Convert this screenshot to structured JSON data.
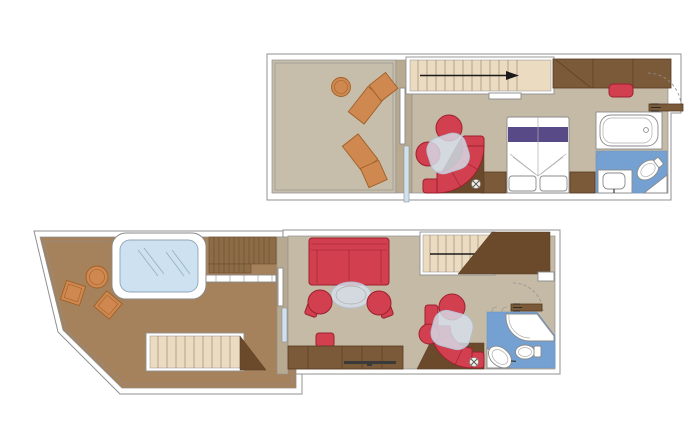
{
  "diagram_type": "cruise-duplex-suite-floor-plan",
  "palette": {
    "page-bg": "#ffffff",
    "wall": "#ffffff",
    "wall-stroke": "#909090",
    "wall-tan": "#b8aa91",
    "floor-tan": "#c5baa5",
    "floor-gray": "#c6bdab",
    "balcony-brown": "#a5815c",
    "slat-brown": "#8c6b47",
    "slat-line": "#6b4c2d",
    "stair-beige": "#eadbc1",
    "tread-line": "#9a8c74",
    "arrow": "#1a1a1a",
    "wood": "#7b5a3a",
    "wood-dark": "#553a20",
    "wood-deep": "#6b4a2c",
    "furn-red": "#d23f4e",
    "furn-red-dark": "#9c2030",
    "orange": "#ce8850",
    "orange-dark": "#a16026",
    "bed-purple": "#584a86",
    "bath-blue": "#74a0d2",
    "tub-blue": "#cde1f0",
    "tub-glass-line": "#93afc5",
    "glass": "#d6dfec",
    "glass-stroke": "#b2c0d2",
    "slider-glass": "#cfe0ee",
    "fixture-stroke": "#8a8a8a"
  },
  "floors": [
    {
      "id": "upper-level",
      "areas": [
        "private-terrace",
        "stair-landing",
        "bedroom",
        "bathtub-room",
        "wc-room"
      ],
      "furniture": [
        "sun-lounger",
        "sun-lounger",
        "round-side-table",
        "sliding-glass-door",
        "staircase",
        "curved-sofa",
        "armchair",
        "armchair",
        "glass-table",
        "double-bed",
        "nightstand",
        "nightstand",
        "wardrobe",
        "bench-stool",
        "entrance-door",
        "bathtub",
        "washbasin",
        "toilet"
      ],
      "stairs_arrow_direction": "right"
    },
    {
      "id": "lower-level",
      "areas": [
        "large-terrace",
        "terrace-deck",
        "terrace-stairs",
        "living-room",
        "stair-hall",
        "bathroom"
      ],
      "furniture": [
        "whirlpool-tub",
        "deck-chair",
        "deck-chair",
        "round-side-table",
        "terrace-staircase",
        "sliding-glass-door",
        "sofa",
        "oval-table",
        "tub-chair",
        "tub-chair",
        "stool",
        "sideboard-desk",
        "tv-panel",
        "curved-sofa",
        "armchair",
        "armchair",
        "glass-table",
        "interior-staircase",
        "entrance-door",
        "shower",
        "washbasin",
        "toilet"
      ],
      "stairs_arrow_direction": "right"
    }
  ]
}
